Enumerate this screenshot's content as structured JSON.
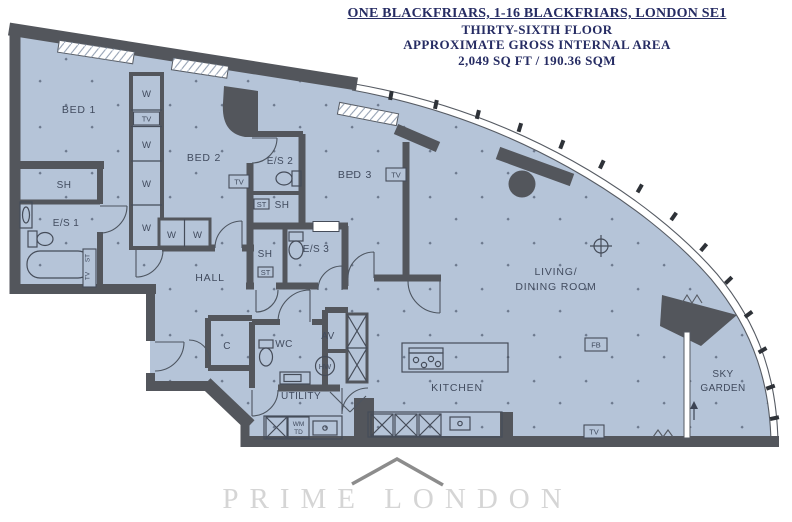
{
  "header": {
    "line1": "ONE BLACKFRIARS, 1-16 BLACKFRIARS, LONDON SE1",
    "line2": "THIRTY-SIXTH FLOOR",
    "line3": "APPROXIMATE GROSS INTERNAL AREA",
    "line4": "2,049 SQ FT / 190.36 SQM"
  },
  "rooms": {
    "bed1": "BED 1",
    "bed2": "BED 2",
    "bed3": "BED 3",
    "es1": "E/S 1",
    "es2": "E/S 2",
    "es3": "E/S 3",
    "sh": "SH",
    "hall": "HALL",
    "closet": "C",
    "wc": "WC",
    "av": "AV",
    "utility": "UTILITY",
    "kitchen": "KITCHEN",
    "living_line1": "LIVING/",
    "living_line2": "DINING ROOM",
    "sky_line1": "SKY",
    "sky_line2": "GARDEN"
  },
  "fixtures": {
    "wardrobe": "W",
    "tv": "TV",
    "storage": "ST",
    "hot_water": "HW",
    "fb": "FB",
    "wm": "WM",
    "td": "TD"
  },
  "watermark": {
    "text": "PRIME LONDON"
  },
  "colors": {
    "floor": "#b5c4d8",
    "wall": "#53565c",
    "title": "#262c63",
    "label": "#414b5e",
    "watermark_text": "#d5d5d5",
    "watermark_chevron": "#8c8c8c"
  }
}
